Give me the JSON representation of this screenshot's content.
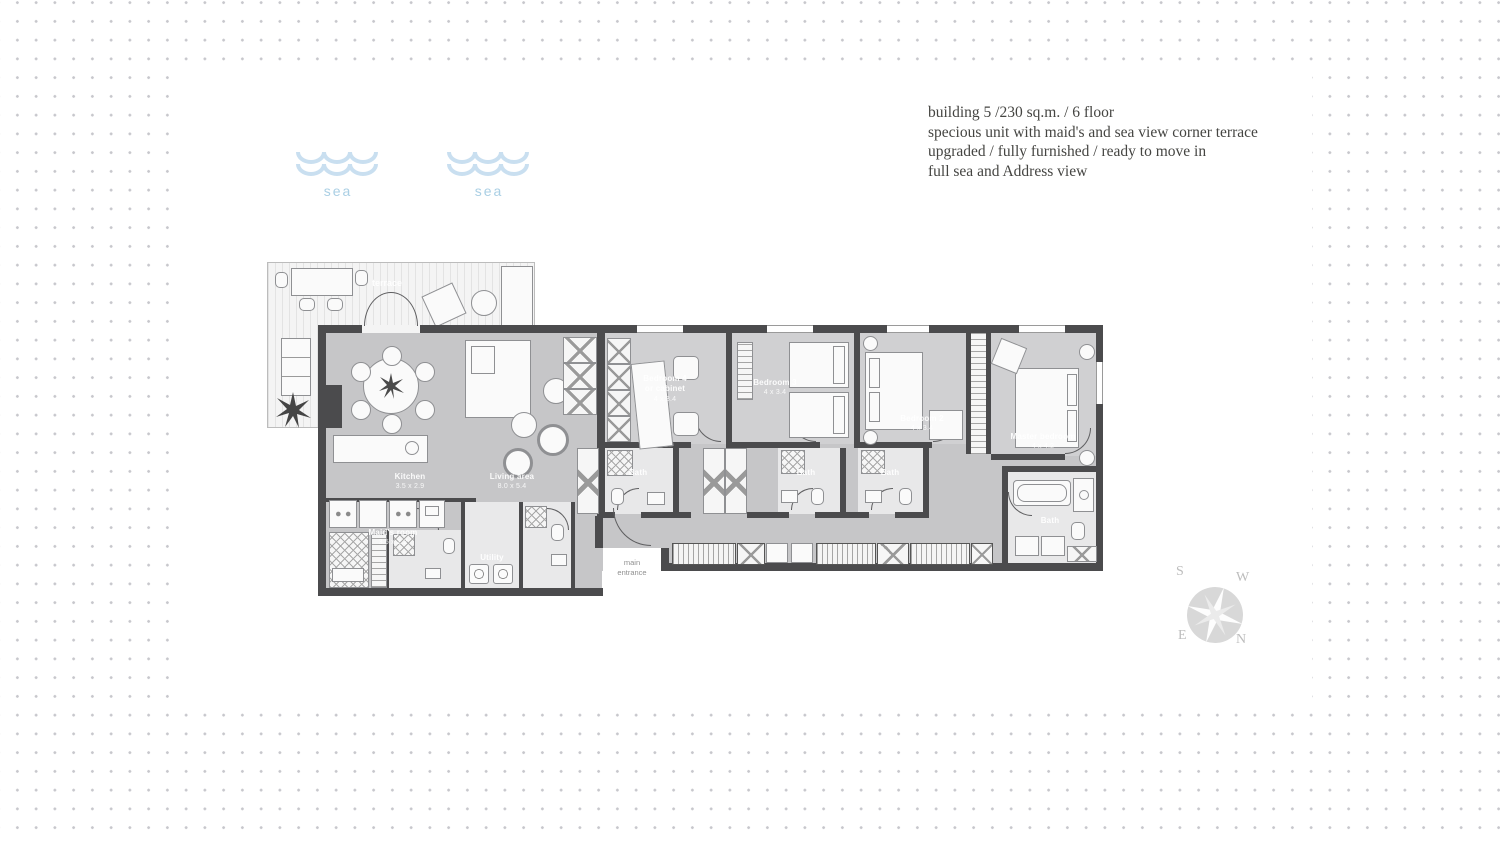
{
  "info": {
    "line1": "building 5 /230 sq.m. / 6 floor",
    "line2": "specious unit with maid's and sea view corner terrace",
    "line3": "upgraded / fully furnished / ready to move in",
    "line4": "full sea and Address view"
  },
  "sea": {
    "label": "sea"
  },
  "rooms": {
    "kitchen": {
      "name": "Kitchen",
      "dims": "3.5 x 2.9"
    },
    "living": {
      "name": "Living area",
      "dims": "8.0 x 5.4"
    },
    "bedroom4": {
      "name": "Bedroom 4",
      "sub": "or cabinet",
      "dims": "4 x 3.4"
    },
    "bedroom3": {
      "name": "Bedroom 3",
      "dims": "4 x 3.4"
    },
    "bedroom2": {
      "name": "Bedroom 2",
      "dims": "4 x 3.4"
    },
    "master": {
      "name": "Master bedroom",
      "dims": "4 x 4.2"
    },
    "maid": {
      "name": "Maid's room",
      "dims": "3.5 x 2.2"
    },
    "utility": {
      "name": "Utility"
    },
    "terrace": {
      "name": "terrace"
    },
    "bath": {
      "name": "Bath"
    }
  },
  "entrance": {
    "line1": "main",
    "line2": "entrance"
  },
  "compass": {
    "s": "S",
    "w": "W",
    "e": "E",
    "n": "N"
  },
  "colors": {
    "wall": "#4b4b4d",
    "floor": "#c6c6c8",
    "sea": "#aacfe4",
    "accent_wave": "#c9dff0"
  }
}
